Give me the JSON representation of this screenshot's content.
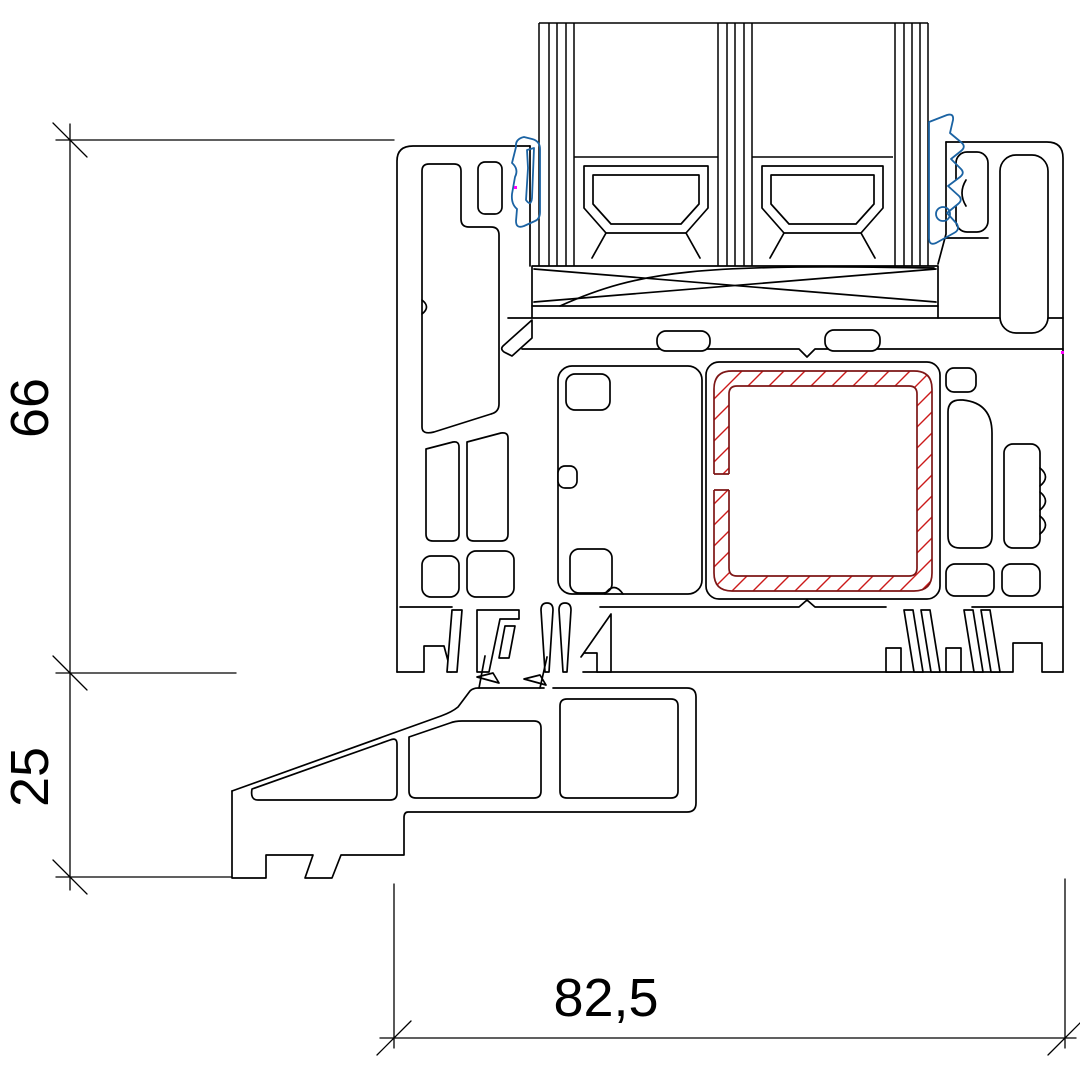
{
  "drawing": {
    "kind": "window-profile-cross-section",
    "dimensions": [
      {
        "id": "frame-height",
        "label": "66",
        "orientation": "vertical"
      },
      {
        "id": "sill-extension-height",
        "label": "25",
        "orientation": "vertical"
      },
      {
        "id": "overall-depth",
        "label": "82,5",
        "orientation": "horizontal"
      }
    ],
    "colors": {
      "line": "#000000",
      "steel_outline": "#7d1616",
      "steel_hatch": "#cc1a1a",
      "gasket_blue": "#1b63a3",
      "artifact_magenta": "#ff00ff",
      "background": "#ffffff"
    },
    "elements": {
      "steel_reinforcement": "hatched-steel-tube",
      "gaskets": "blue-glazing-gaskets",
      "glazing": "double-glazing-unit"
    }
  }
}
